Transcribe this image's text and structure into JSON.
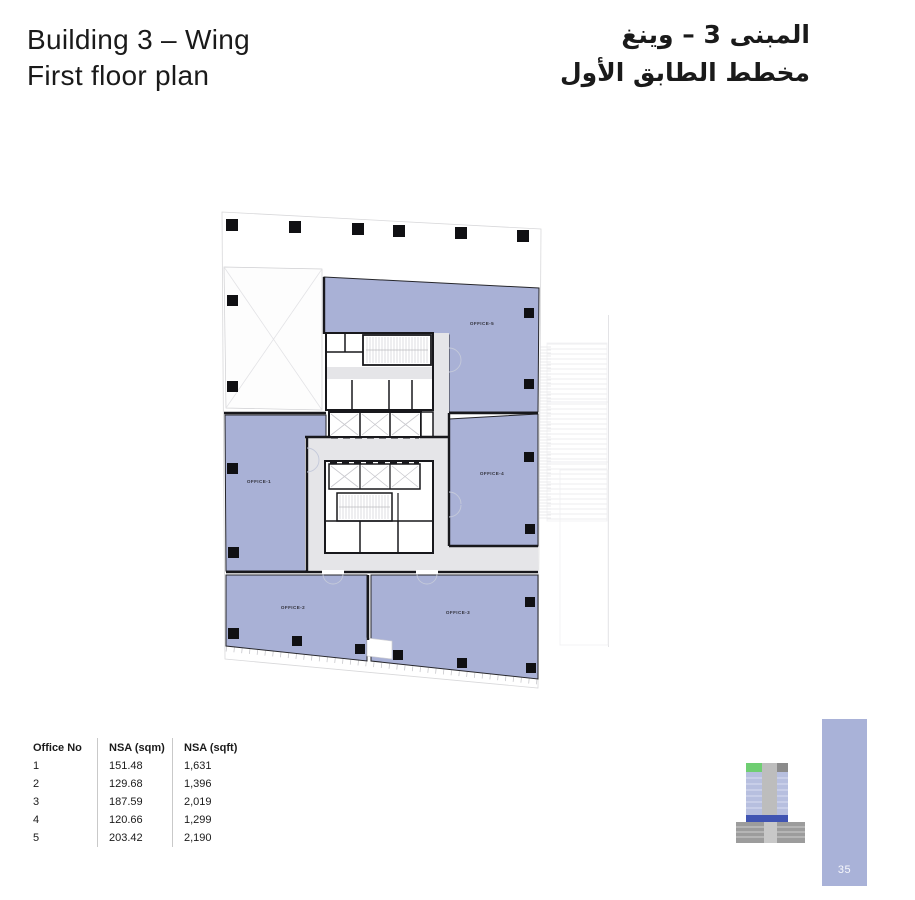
{
  "header": {
    "title_line1": "Building 3 – Wing",
    "title_line2": "First floor plan",
    "title_arabic_line1": "المبنى 3 – وينغ",
    "title_arabic_line2": "مخطط الطابق الأول"
  },
  "plan": {
    "offices": [
      {
        "label": "OFFICE-1"
      },
      {
        "label": "OFFICE-2"
      },
      {
        "label": "OFFICE-3"
      },
      {
        "label": "OFFICE-4"
      },
      {
        "label": "OFFICE-5"
      }
    ]
  },
  "table": {
    "headers": [
      "Office No",
      "NSA (sqm)",
      "NSA (sqft)"
    ],
    "rows": [
      [
        "1",
        "151.48",
        "1,631"
      ],
      [
        "2",
        "129.68",
        "1,396"
      ],
      [
        "3",
        "187.59",
        "2,019"
      ],
      [
        "4",
        "120.66",
        "1,299"
      ],
      [
        "5",
        "203.42",
        "2,190"
      ]
    ]
  },
  "page": {
    "number": "35"
  },
  "colors": {
    "office_fill": "#a9b1d6",
    "corridor": "#e5e5e8",
    "wall": "#18181c",
    "page_bar": "#a9b2d8",
    "icon_green": "#6fce72",
    "icon_blue": "#4054b2",
    "icon_gray": "#9c9c9c"
  }
}
